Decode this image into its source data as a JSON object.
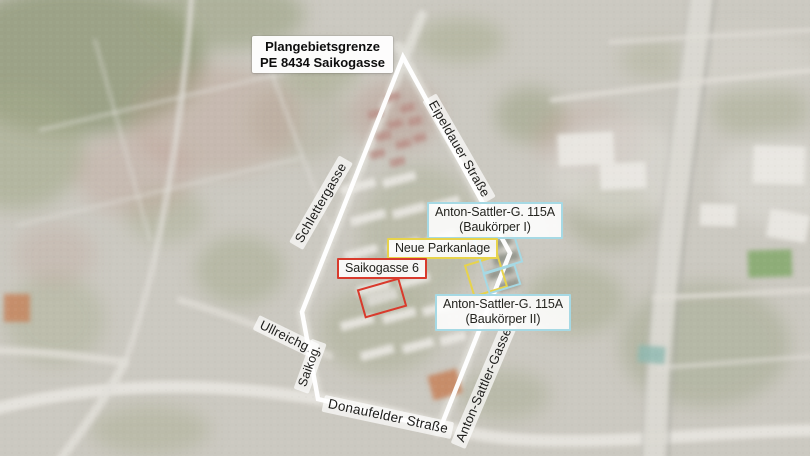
{
  "map": {
    "plan_label": {
      "line1": "Plangebietsgrenze",
      "line2": "PE 8434 Saikogasse"
    },
    "streets": [
      {
        "name": "schlettergasse",
        "label": "Schlettergasse"
      },
      {
        "name": "eipeldauer-strasse",
        "label": "Eipeldauer Straße"
      },
      {
        "name": "ullreichgasse",
        "label": "Ullreichg."
      },
      {
        "name": "saikogasse",
        "label": "Saikog."
      },
      {
        "name": "donaufelder-strasse",
        "label": "Donaufelder Straße"
      },
      {
        "name": "anton-sattler-gasse",
        "label": "Anton-Sattler-Gasse"
      }
    ],
    "callouts": [
      {
        "name": "baukoerper-1",
        "line1": "Anton-Sattler-G. 115A",
        "line2": "(Baukörper I)",
        "color": "#a6d9e4"
      },
      {
        "name": "neue-parkanlage",
        "line1": "Neue Parkanlage",
        "line2": "",
        "color": "#e7d34b"
      },
      {
        "name": "saikogasse-6",
        "line1": "Saikogasse 6",
        "line2": "",
        "color": "#d93a2c"
      },
      {
        "name": "baukoerper-2",
        "line1": "Anton-Sattler-G. 115A",
        "line2": "(Baukörper II)",
        "color": "#a6d9e4"
      }
    ],
    "colors": {
      "boundary": "#ffffff",
      "highlight_red": "#d93a2c",
      "highlight_yellow": "#e7d34b",
      "highlight_cyan": "#a6d9e4"
    }
  }
}
